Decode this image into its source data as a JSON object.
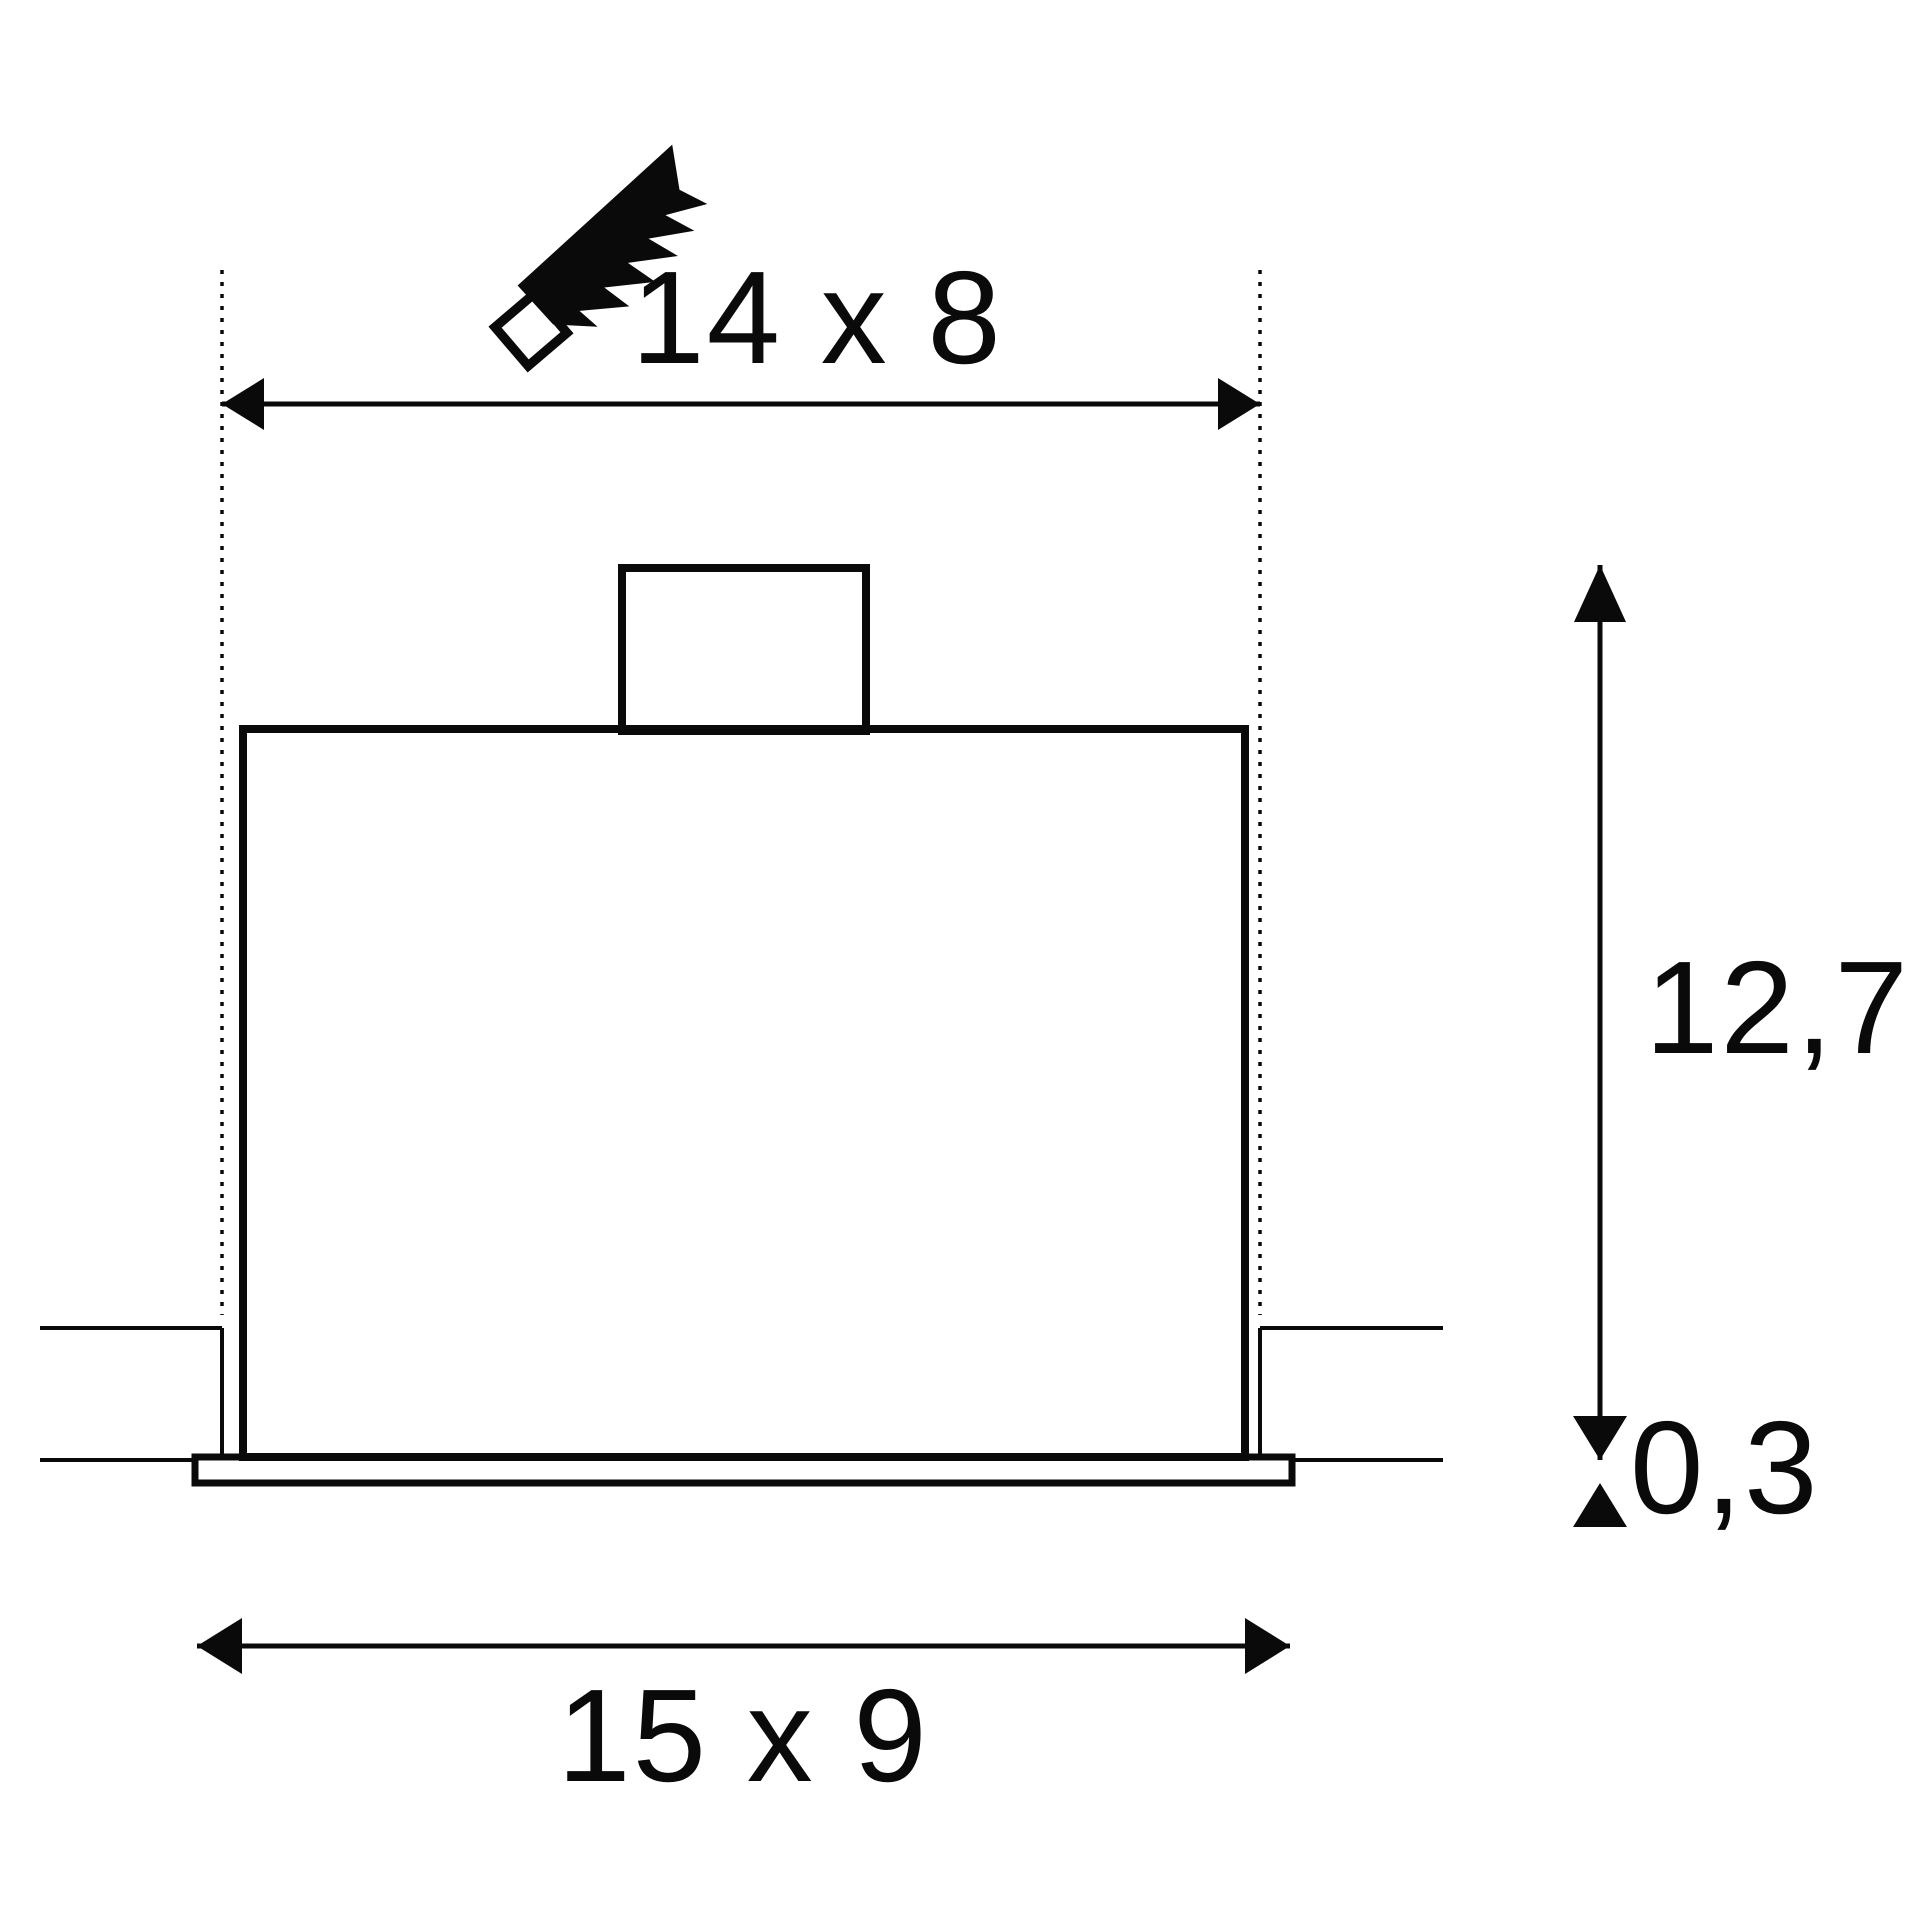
{
  "meta": {
    "description": "Technical installation dimension drawing of a square recessed ceiling luminaire (cross-section)",
    "units_shown": "cm (implied, not printed)"
  },
  "colors": {
    "ink": "#0a0a0a",
    "background": "#ffffff"
  },
  "icons": {
    "saw": "handsaw cut-out symbol"
  },
  "dimensions": {
    "cutout": {
      "label": "14 x 8",
      "meaning": "ceiling cut-out size"
    },
    "recess_depth": {
      "label": "12,7",
      "meaning": "recessed installation depth"
    },
    "frame_thickness": {
      "label": "0,3",
      "meaning": "trim frame thickness below ceiling"
    },
    "fixture": {
      "label": "15 x 9",
      "meaning": "outer trim frame size"
    }
  }
}
